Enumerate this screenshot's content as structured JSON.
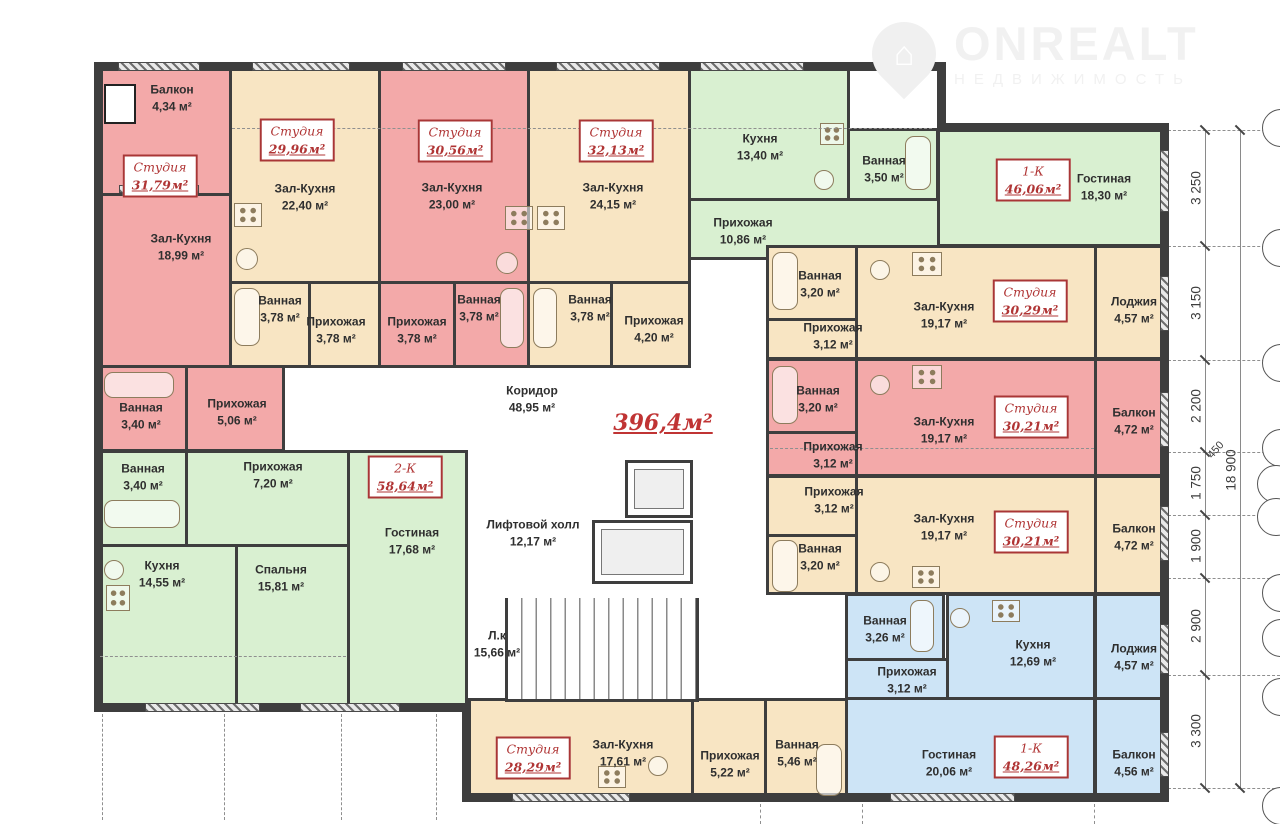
{
  "logo": {
    "brand": "ONREALT",
    "subtitle": "НЕДВИЖИМОСТЬ"
  },
  "total_area": "396,4м²",
  "units": [
    {
      "t": "Студия",
      "a": "31,79м²"
    },
    {
      "t": "Студия",
      "a": "29,96м²"
    },
    {
      "t": "Студия",
      "a": "30,56м²"
    },
    {
      "t": "Студия",
      "a": "32,13м²"
    },
    {
      "t": "1-К",
      "a": "46,06м²"
    },
    {
      "t": "Студия",
      "a": "30,29м²"
    },
    {
      "t": "Студия",
      "a": "30,21м²"
    },
    {
      "t": "Студия",
      "a": "30,21м²"
    },
    {
      "t": "2-К",
      "a": "58,64м²"
    },
    {
      "t": "Студия",
      "a": "28,29м²"
    },
    {
      "t": "1-К",
      "a": "48,26м²"
    }
  ],
  "rooms": [
    {
      "n": "Балкон",
      "a": "4,34 м²"
    },
    {
      "n": "Зал-Кухня",
      "a": "18,99 м²"
    },
    {
      "n": "Ванная",
      "a": "3,40 м²"
    },
    {
      "n": "Прихожая",
      "a": "5,06 м²"
    },
    {
      "n": "Зал-Кухня",
      "a": "22,40 м²"
    },
    {
      "n": "Ванная",
      "a": "3,78 м²"
    },
    {
      "n": "Прихожая",
      "a": "3,78 м²"
    },
    {
      "n": "Зал-Кухня",
      "a": "23,00 м²"
    },
    {
      "n": "Прихожая",
      "a": "3,78 м²"
    },
    {
      "n": "Ванная",
      "a": "3,78 м²"
    },
    {
      "n": "Зал-Кухня",
      "a": "24,15 м²"
    },
    {
      "n": "Ванная",
      "a": "3,78 м²"
    },
    {
      "n": "Прихожая",
      "a": "4,20 м²"
    },
    {
      "n": "Кухня",
      "a": "13,40 м²"
    },
    {
      "n": "Ванная",
      "a": "3,50 м²"
    },
    {
      "n": "Прихожая",
      "a": "10,86 м²"
    },
    {
      "n": "Гостиная",
      "a": "18,30 м²"
    },
    {
      "n": "Ванная",
      "a": "3,20 м²"
    },
    {
      "n": "Прихожая",
      "a": "3,12 м²"
    },
    {
      "n": "Зал-Кухня",
      "a": "19,17 м²"
    },
    {
      "n": "Лоджия",
      "a": "4,57 м²"
    },
    {
      "n": "Ванная",
      "a": "3,20 м²"
    },
    {
      "n": "Прихожая",
      "a": "3,12 м²"
    },
    {
      "n": "Зал-Кухня",
      "a": "19,17 м²"
    },
    {
      "n": "Балкон",
      "a": "4,72 м²"
    },
    {
      "n": "Прихожая",
      "a": "3,12 м²"
    },
    {
      "n": "Ванная",
      "a": "3,20 м²"
    },
    {
      "n": "Зал-Кухня",
      "a": "19,17 м²"
    },
    {
      "n": "Балкон",
      "a": "4,72 м²"
    },
    {
      "n": "Ванная",
      "a": "3,26 м²"
    },
    {
      "n": "Прихожая",
      "a": "3,12 м²"
    },
    {
      "n": "Кухня",
      "a": "12,69 м²"
    },
    {
      "n": "Лоджия",
      "a": "4,57 м²"
    },
    {
      "n": "Гостиная",
      "a": "20,06 м²"
    },
    {
      "n": "Балкон",
      "a": "4,56 м²"
    },
    {
      "n": "Ванная",
      "a": "3,40 м²"
    },
    {
      "n": "Прихожая",
      "a": "7,20 м²"
    },
    {
      "n": "Гостиная",
      "a": "17,68 м²"
    },
    {
      "n": "Кухня",
      "a": "14,55 м²"
    },
    {
      "n": "Спальня",
      "a": "15,81 м²"
    },
    {
      "n": "Коридор",
      "a": "48,95 м²"
    },
    {
      "n": "Лифтовой холл",
      "a": "12,17 м²"
    },
    {
      "n": "Л.к",
      "a": "15,66 м²"
    },
    {
      "n": "Зал-Кухня",
      "a": "17,61 м²"
    },
    {
      "n": "Прихожая",
      "a": "5,22 м²"
    },
    {
      "n": "Ванная",
      "a": "5,46 м²"
    }
  ],
  "dims": {
    "right": [
      "3 250",
      "3 150",
      "2 200",
      "1 750",
      "1 900",
      "2 900",
      "3 300"
    ],
    "overall": "18 900",
    "offset": "450"
  },
  "colors": {
    "pink": "#f3a9a9",
    "beige": "#f8e5c3",
    "green": "#d9f0d1",
    "blue": "#cde4f6",
    "wall": "#3e3e3e",
    "accent_red": "#b03535"
  },
  "icons": {
    "pin": "map-pin-house-icon",
    "tub": "bathtub-icon",
    "sink": "sink-icon",
    "stove": "stove-icon",
    "elevator": "elevator-icon",
    "stairs": "stairs-icon"
  }
}
